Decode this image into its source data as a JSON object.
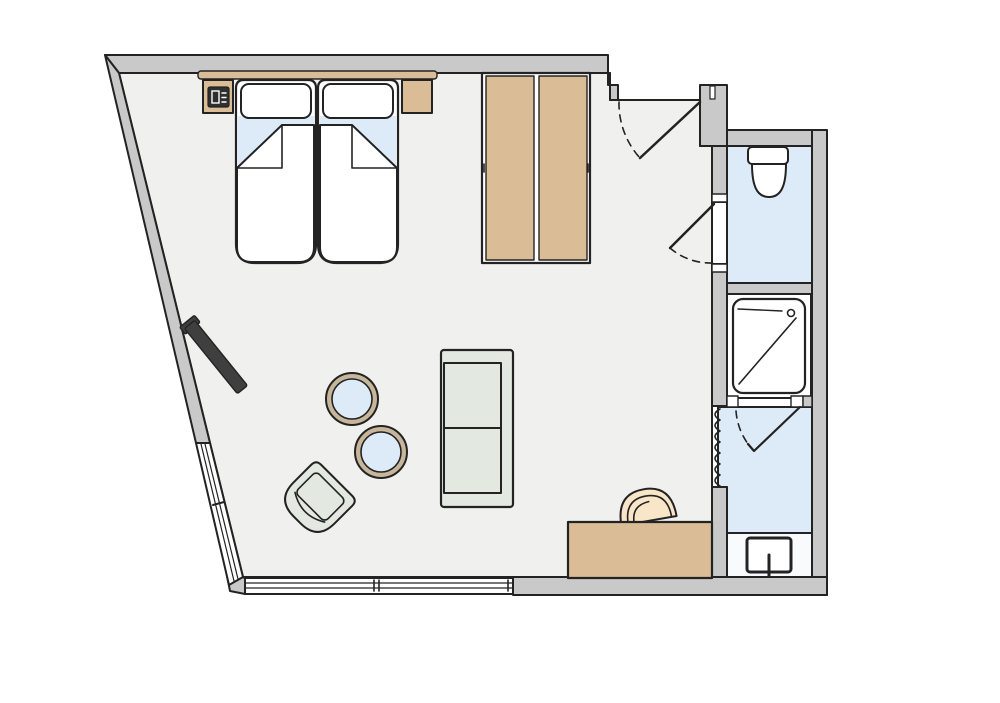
{
  "colors": {
    "background": "#ffffff",
    "wall_fill": "#c9c9c9",
    "outline": "#232323",
    "floor": "#f0f0ee",
    "water_blue": "#dcebf7",
    "wood": "#dabd97",
    "table_rim": "#c7b69a",
    "upholstery": "#e3e8e0",
    "seat_cream": "#f9e6c8",
    "tv_dark": "#3f3f3f",
    "fixture_white": "#ffffff",
    "basin_floor": "#f8fafc",
    "phone_dark": "#2f2f2f"
  },
  "plan": {
    "rooms": [
      {
        "name": "main-room",
        "floor": "light-gray"
      },
      {
        "name": "entry-nook",
        "floor": "light-gray"
      },
      {
        "name": "wc-room",
        "floor": "light-blue"
      },
      {
        "name": "shower-room",
        "floor": "white"
      },
      {
        "name": "bathroom",
        "floor": "light-blue"
      },
      {
        "name": "washbasin-area",
        "floor": "white"
      }
    ],
    "furniture": [
      {
        "name": "twin-bed",
        "count": 2,
        "parts": [
          "mattress",
          "pillow",
          "folded-blanket",
          "blue-sheet"
        ]
      },
      {
        "name": "headboard-shelf",
        "count": 1
      },
      {
        "name": "nightstand",
        "count": 2
      },
      {
        "name": "bedside-phone",
        "count": 1
      },
      {
        "name": "wardrobe",
        "doors": 2
      },
      {
        "name": "wall-tv",
        "count": 1
      },
      {
        "name": "sofa-two-seater",
        "count": 1
      },
      {
        "name": "round-coffee-table",
        "count": 2
      },
      {
        "name": "lounge-chair",
        "count": 1
      },
      {
        "name": "desk",
        "count": 1
      },
      {
        "name": "desk-chair",
        "count": 1
      },
      {
        "name": "toilet",
        "count": 1
      },
      {
        "name": "shower-tray",
        "count": 1
      },
      {
        "name": "washbasin-sink",
        "count": 1
      }
    ],
    "doors": [
      {
        "name": "entry-door",
        "type": "swing",
        "state": "shown-open-with-arc"
      },
      {
        "name": "wc-door",
        "type": "swing",
        "state": "shown-open-with-arc"
      },
      {
        "name": "shower-door",
        "type": "swing",
        "state": "shown-open-with-arc"
      },
      {
        "name": "bathroom-folding-door",
        "type": "accordion"
      }
    ],
    "windows": [
      {
        "name": "slanted-window",
        "position": "lower-left-angled-wall"
      },
      {
        "name": "bottom-window",
        "position": "bottom-wall"
      }
    ]
  }
}
